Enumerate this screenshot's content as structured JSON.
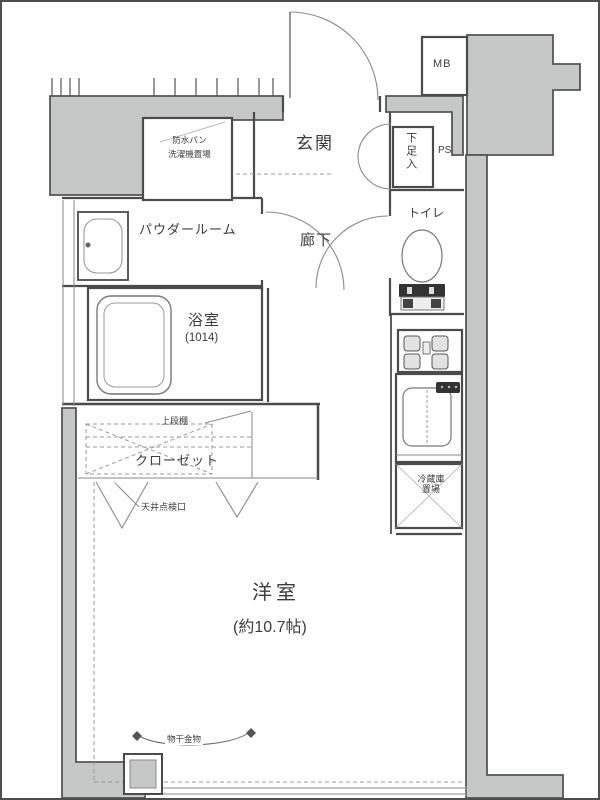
{
  "labels": {
    "genkan": "玄関",
    "hallway": "廊下",
    "toilet": "トイレ",
    "powder_room": "パウダールーム",
    "bath": "浴室",
    "bath_size": "(1014)",
    "room": "洋室",
    "room_size": "(約10.7帖)",
    "closet": "クローゼット",
    "mb": "MB",
    "ps": "PS",
    "shoe_cabinet": "下足入",
    "washer_line1": "防水パン",
    "washer_line2": "洗濯機置場",
    "upper_shelf": "上段棚",
    "ceiling_access": "天井点検口",
    "fridge_line1": "冷蔵庫",
    "fridge_line2": "置場",
    "laundry_hook": "物干金物"
  },
  "colors": {
    "common_area_fill": "#c6c8c7",
    "wall_line": "#4b4b4b",
    "thin_line": "#8a8a8a",
    "text": "#3c3c3c"
  }
}
